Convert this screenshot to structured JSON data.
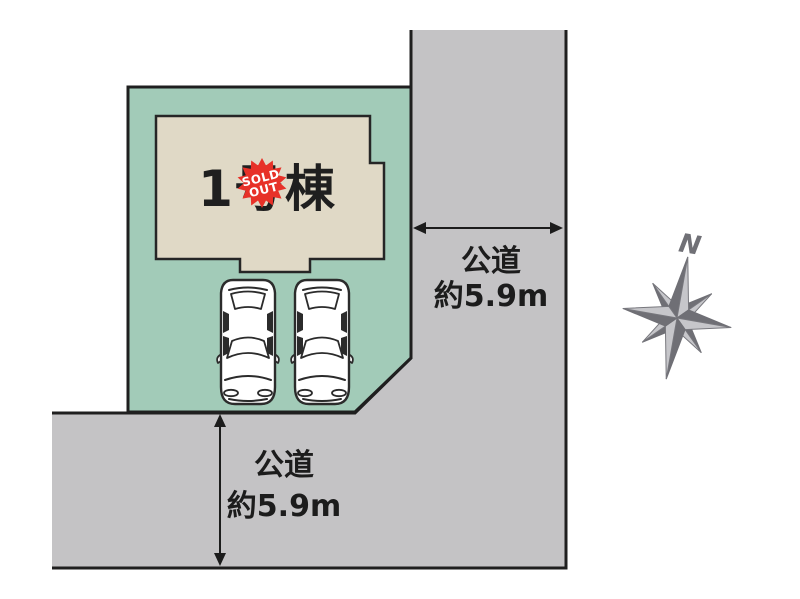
{
  "site_plan": {
    "building": {
      "label": "1号棟"
    },
    "badge": {
      "line1": "SOLD",
      "line2": "OUT"
    },
    "east_road": {
      "name": "公道",
      "width": "約5.9m"
    },
    "south_road": {
      "name": "公道",
      "width": "約5.9m"
    },
    "compass": {
      "north": "N"
    },
    "icons": {
      "cars": "car-top-view-icon",
      "compass": "compass-rose-icon",
      "badge": "sold-out-starburst-icon"
    },
    "colors": {
      "lot_green": "#a2cbb8",
      "building_cream": "#e0d9c6",
      "road_gray": "#c4c3c5",
      "badge_red": "#e73128",
      "outline_black": "#1f1f1f",
      "compass_gray": "#707076"
    }
  }
}
